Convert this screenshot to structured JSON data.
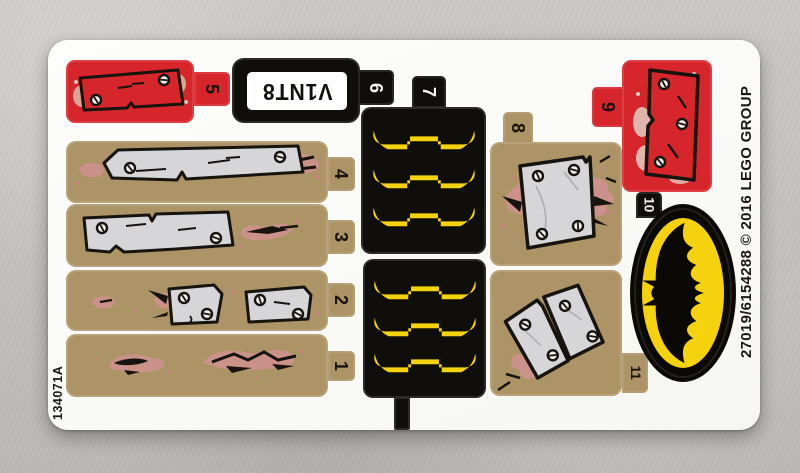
{
  "sheet": {
    "left_code": "134071A",
    "right_code": "27019/6154288 © 2016 LEGO GROUP",
    "plate_text": "V1NT8",
    "numbers": {
      "n1": "1",
      "n2": "2",
      "n3": "3",
      "n4": "4",
      "n5": "5",
      "n6": "6",
      "n7": "7",
      "n8": "8",
      "n9": "9",
      "n10": "10",
      "n11": "11"
    },
    "colors": {
      "red": "#d6252b",
      "tan": "#ac9467",
      "black": "#100e0b",
      "yellow": "#f4d20d",
      "plank_grey": "#d6d6d8",
      "crack_pink": "#cb9289",
      "sheet_white": "#fbfbf8",
      "backing_grey": "#c6c4c1"
    },
    "icons": {
      "screw": "screw-icon",
      "bat": "batman-logo",
      "claw": "claw-marks"
    }
  }
}
